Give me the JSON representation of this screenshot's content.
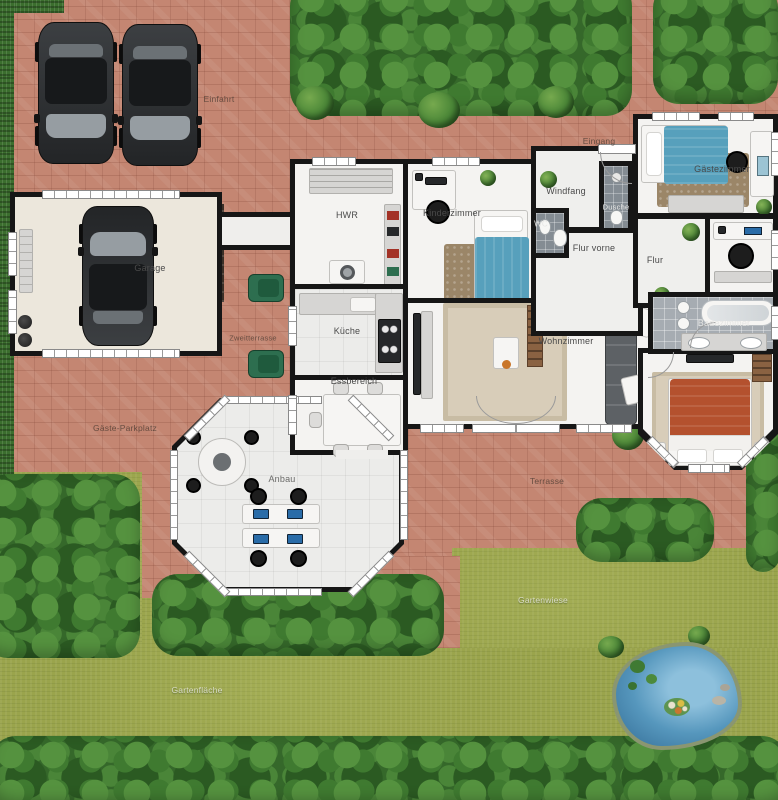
{
  "labels": {
    "einfahrt": "Einfahrt",
    "eingang": "Eingang",
    "garage": "Garage",
    "hwr": "HWR",
    "kinderzimmer": "Kinderzimmer",
    "windfang": "Windfang",
    "dusche": "Dusche",
    "wc": "WC",
    "gaestezimmer": "Gästezimmer",
    "flur_vorne": "Flur vorne",
    "flur": "Flur",
    "kueche": "Küche",
    "essbereich": "Essbereich",
    "wohnzimmer": "Wohnzimmer",
    "badezimmer": "Badezimmer",
    "zweitterrasse": "Zweitterrasse",
    "anbau": "Anbau",
    "terrasse": "Terrasse",
    "gaeste_parkplatz": "Gäste-Parkplatz",
    "gartenwiese": "Gartenwiese",
    "gartenflaeche": "Gartenfläche"
  },
  "palette": {
    "paving": "#c48672",
    "grass": "#9aa44c",
    "hedge": "#3c712e",
    "wall": "#161616",
    "floor": "#f4f3f1",
    "water": "#4d8fb5",
    "bed_blue": "#57a0bc",
    "bed_red": "#b4512e",
    "rug_beige": "#d8cdb9",
    "rug_brown": "#9b8668",
    "chair_green": "#2d6e4f"
  }
}
